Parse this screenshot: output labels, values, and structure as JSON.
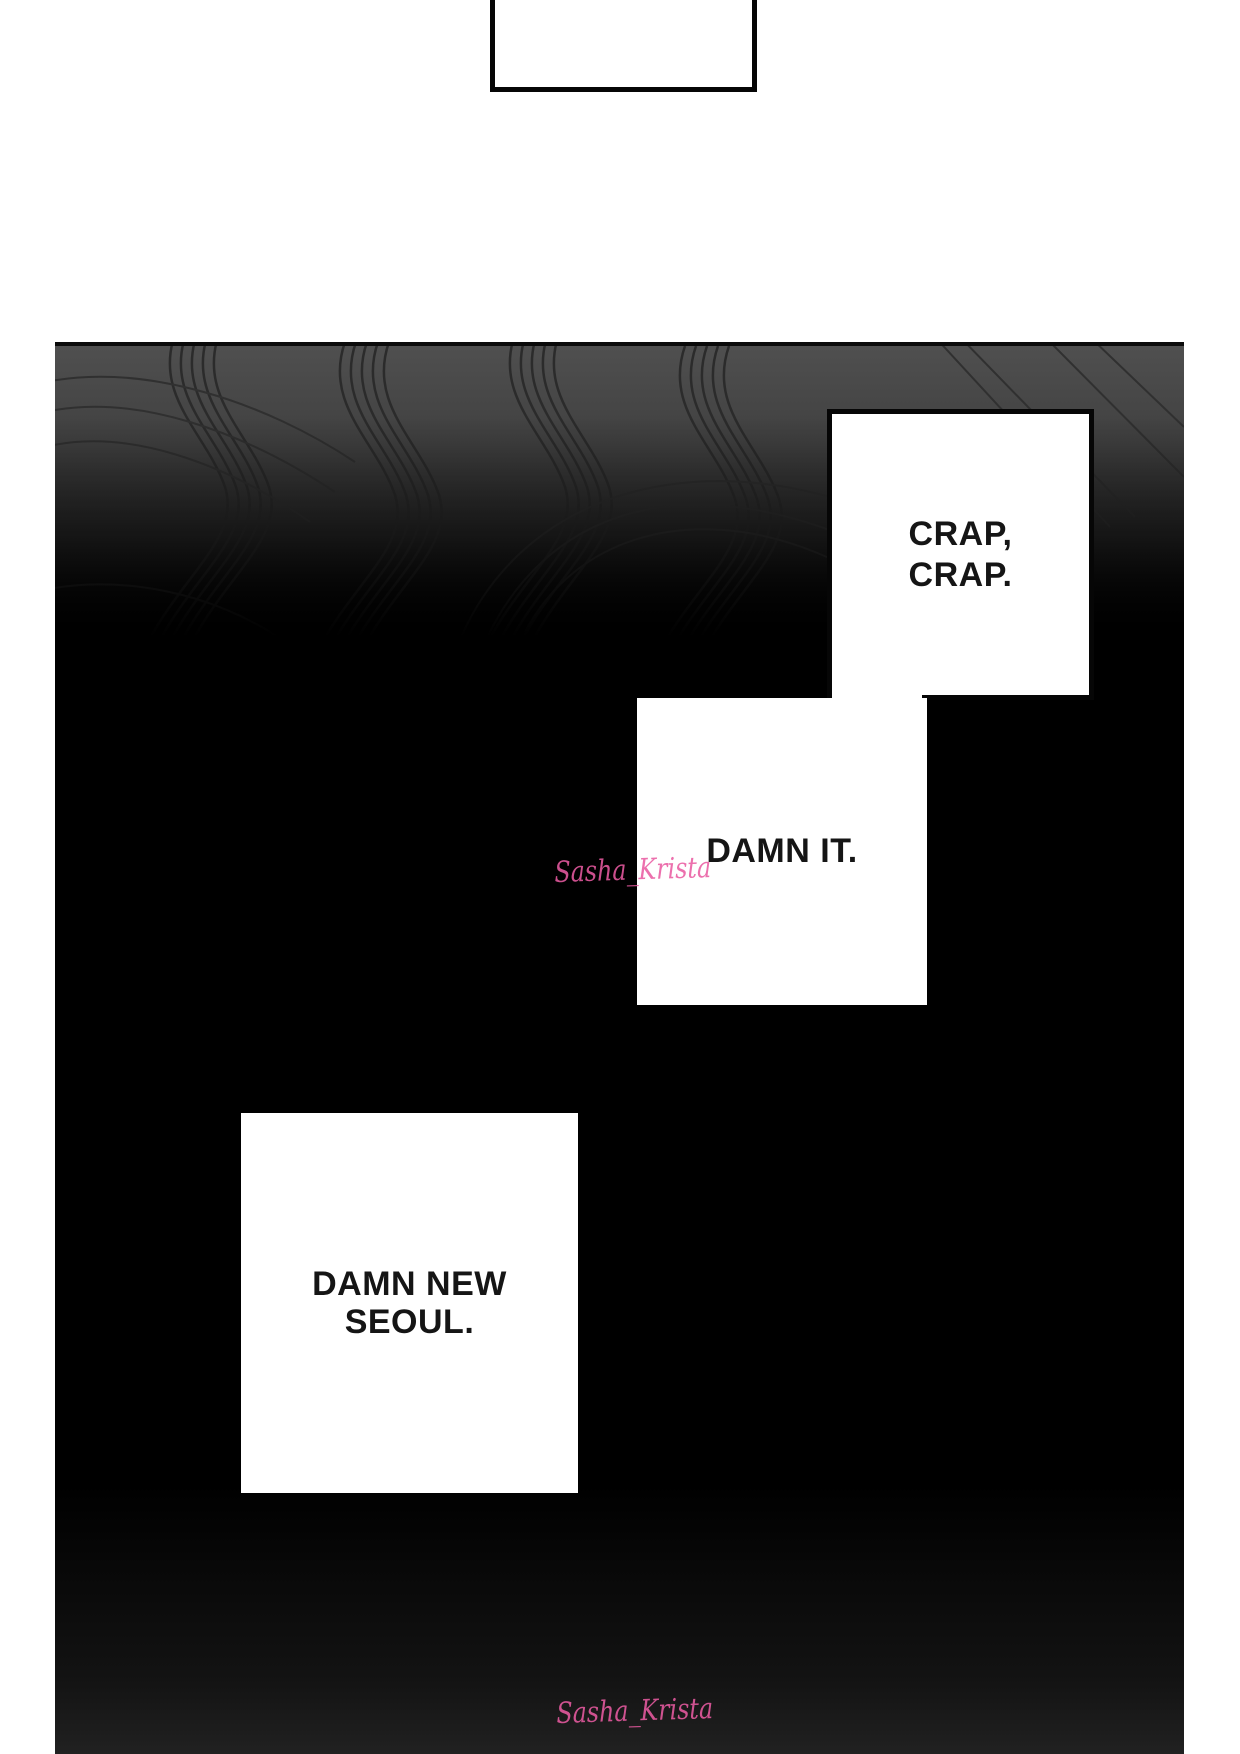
{
  "comic": {
    "speech_bubbles": {
      "top": {
        "text": ""
      },
      "crap": {
        "line1": "CRAP,",
        "line2": "CRAP."
      },
      "damn_it": {
        "text": "DAMN IT."
      },
      "new_seoul": {
        "line1": "DAMN NEW",
        "line2": "SEOUL."
      }
    },
    "watermark": {
      "text": "Sasha_Krista",
      "color": "#ea5ba2"
    },
    "colors": {
      "page_background": "#ffffff",
      "panel_background": "#000000",
      "swirl_gray_top": "#505050",
      "swirl_line": "#2b2b2b",
      "bubble_background": "#ffffff",
      "bubble_border": "#060606",
      "speech_text": "#151515"
    }
  }
}
